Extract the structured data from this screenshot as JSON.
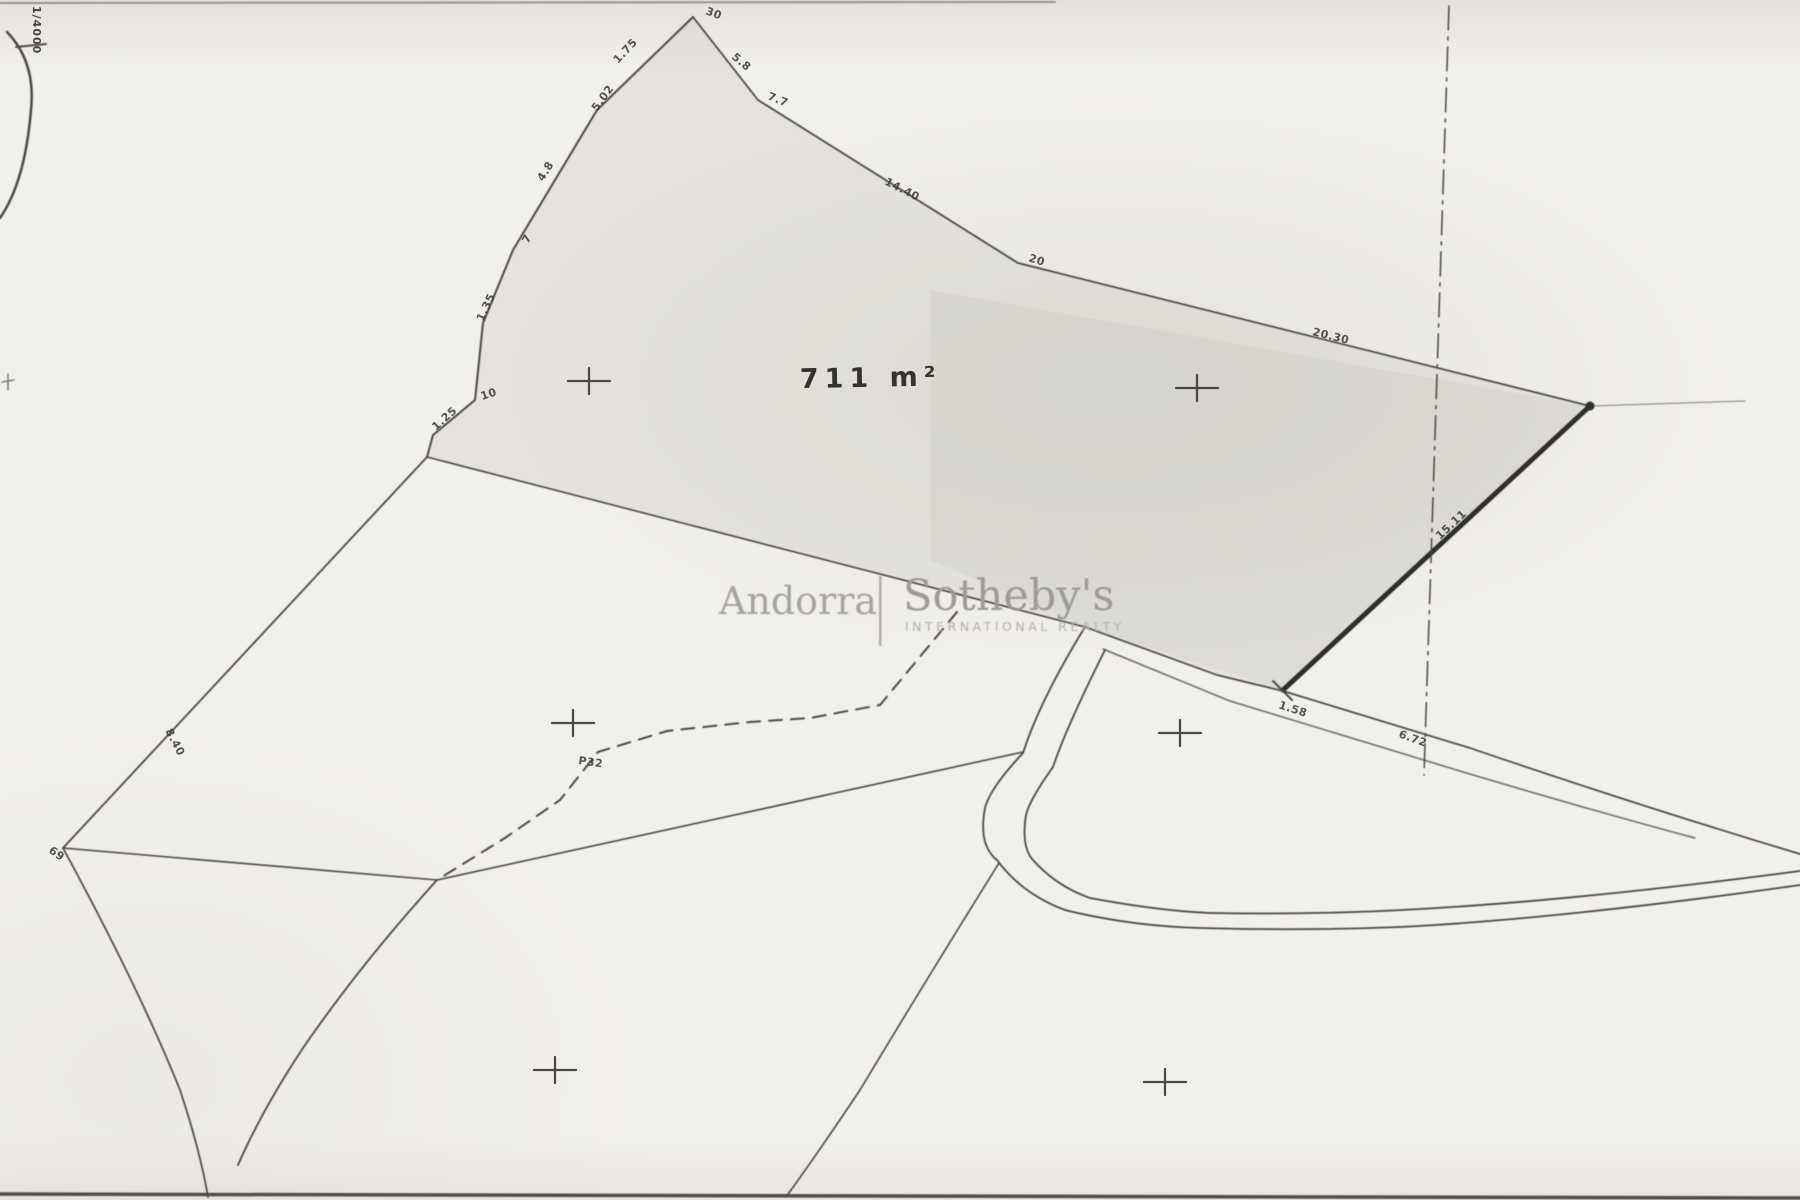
{
  "plan": {
    "area_label": "711 m²",
    "scale_label": "1/4000",
    "point_label": "P32"
  },
  "watermark": {
    "brand_left": "Andorra",
    "brand_right": "Sotheby's",
    "tagline": "INTERNATIONAL REALTY"
  },
  "measurements": [
    {
      "id": "apex-right",
      "text": "30"
    },
    {
      "id": "right-1",
      "text": "5.8"
    },
    {
      "id": "right-2",
      "text": "7.7"
    },
    {
      "id": "right-3",
      "text": "14.40"
    },
    {
      "id": "right-4",
      "text": "20"
    },
    {
      "id": "right-5",
      "text": "20.30"
    },
    {
      "id": "left-1",
      "text": "1.75"
    },
    {
      "id": "left-2",
      "text": "5.02"
    },
    {
      "id": "left-3",
      "text": "4.8"
    },
    {
      "id": "left-4",
      "text": "7"
    },
    {
      "id": "left-5",
      "text": "1.35"
    },
    {
      "id": "left-6",
      "text": "10"
    },
    {
      "id": "left-7",
      "text": "1.25"
    },
    {
      "id": "west-edge",
      "text": "8.40"
    },
    {
      "id": "west-vertex",
      "text": "69"
    },
    {
      "id": "wall-length",
      "text": "15.11"
    },
    {
      "id": "wall-end",
      "text": "1.58"
    },
    {
      "id": "path-length",
      "text": "6.72"
    }
  ],
  "colors": {
    "paper": "#f2f0ec",
    "ink": "#4a4845",
    "thick_ink": "#2f2e2c",
    "watermark_gray": "#a09e9b",
    "parcel_shade": "#bab5ae"
  }
}
